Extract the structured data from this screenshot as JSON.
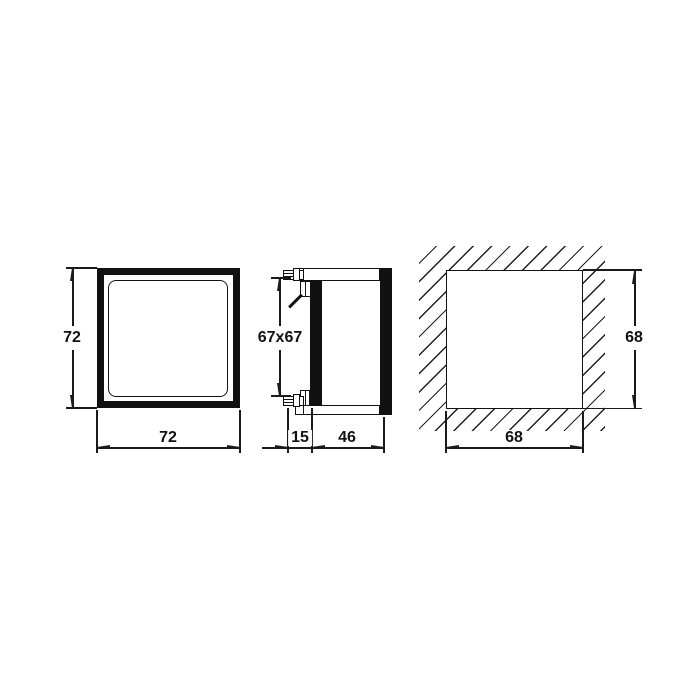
{
  "drawing": {
    "description": "Technical dimension drawing of a 72x72 panel-mount instrument: front view, side view and panel cut-out view",
    "front_view": {
      "height_dim": "72",
      "width_dim": "72"
    },
    "side_view": {
      "body_dim": "67x67",
      "front_depth_dim": "15",
      "rear_depth_dim": "46"
    },
    "cutout_view": {
      "height_dim": "68",
      "width_dim": "68"
    }
  },
  "colors": {
    "background": "#ffffff",
    "line": "#1a1a1a",
    "solid_fill": "#111111"
  }
}
